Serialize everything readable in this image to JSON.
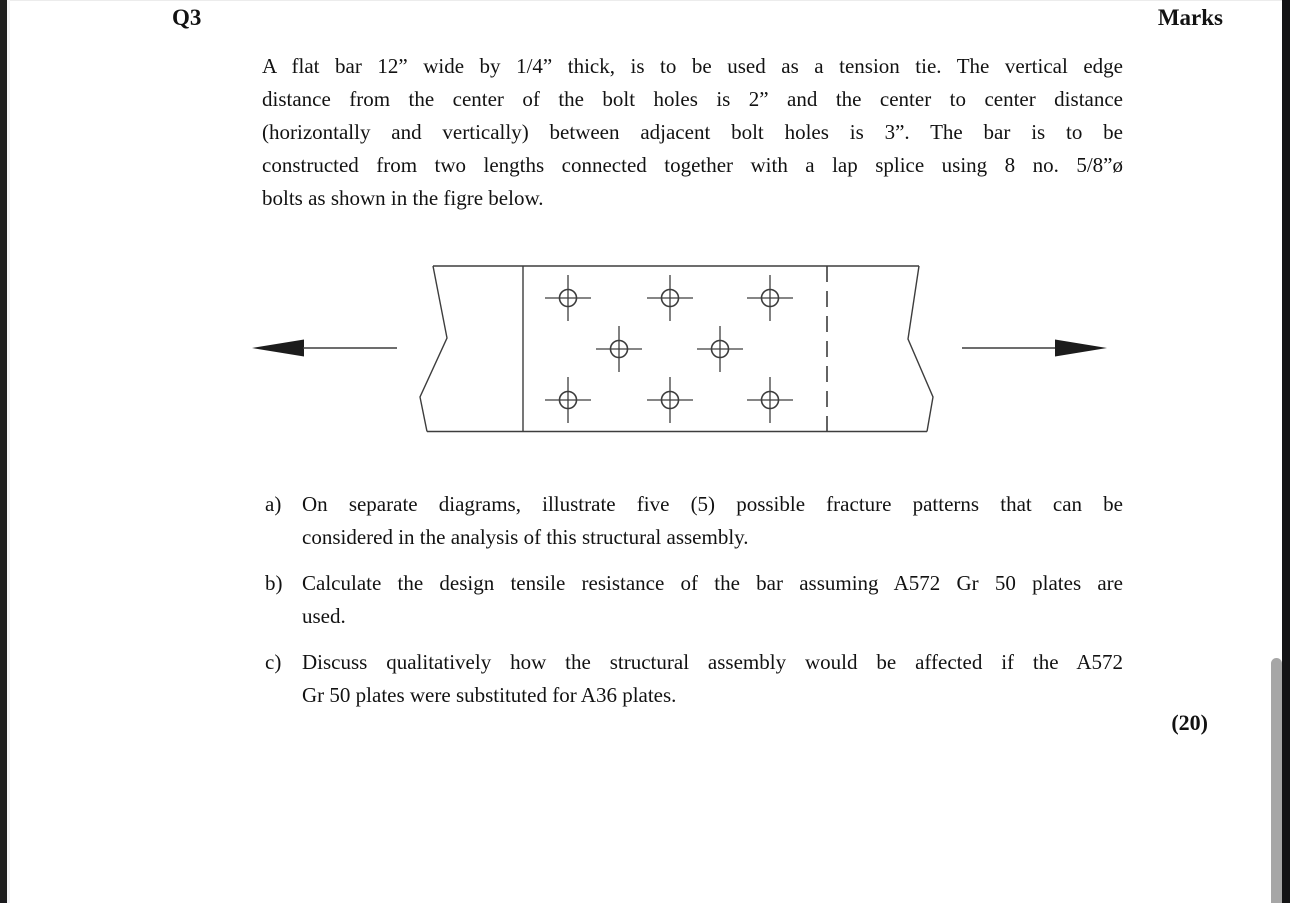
{
  "page": {
    "question_id": "Q3",
    "marks_label": "Marks",
    "marks_total": "(20)"
  },
  "intro": {
    "lines": [
      "A flat bar 12” wide by 1/4” thick, is to be used as a tension tie. The vertical edge",
      "distance from the center of the bolt holes is 2” and the center to center distance",
      "(horizontally and vertically) between adjacent bolt holes is 3”. The bar is to be",
      "constructed from two lengths connected together with a lap splice using 8 no. 5/8”ø",
      "bolts as shown in the figre below."
    ]
  },
  "items": [
    {
      "label": "a)",
      "lines": [
        "On separate diagrams, illustrate five (5) possible fracture patterns that can be",
        "considered in the analysis of this structural assembly."
      ]
    },
    {
      "label": "b)",
      "lines": [
        "Calculate the design tensile resistance of the bar assuming A572 Gr 50 plates are",
        "used."
      ]
    },
    {
      "label": "c)",
      "lines": [
        "Discuss qualitatively how the structural assembly would be affected if the A572",
        "Gr 50 plates were substituted for A36 plates."
      ]
    }
  ],
  "figure": {
    "type": "engineering-drawing",
    "description": "plan view of lap-spliced flat bar tension tie with 8 bolt holes and opposing tension force arrows",
    "bolt_symbol": "circle-crosshair",
    "bolt_count": 8,
    "bolt_holes": [
      [
        568,
        298
      ],
      [
        670,
        298
      ],
      [
        770,
        298
      ],
      [
        619,
        349
      ],
      [
        720,
        349
      ],
      [
        568,
        400
      ],
      [
        670,
        400
      ],
      [
        770,
        400
      ]
    ]
  },
  "colors": {
    "page_bg": "#ffffff",
    "text": "#121212",
    "drawing_line": "#3d3d3d",
    "arrow_fill": "#1c1c1c",
    "side_bar": "#1a1a1c",
    "scrollbar_thumb": "#a6a6a6"
  }
}
